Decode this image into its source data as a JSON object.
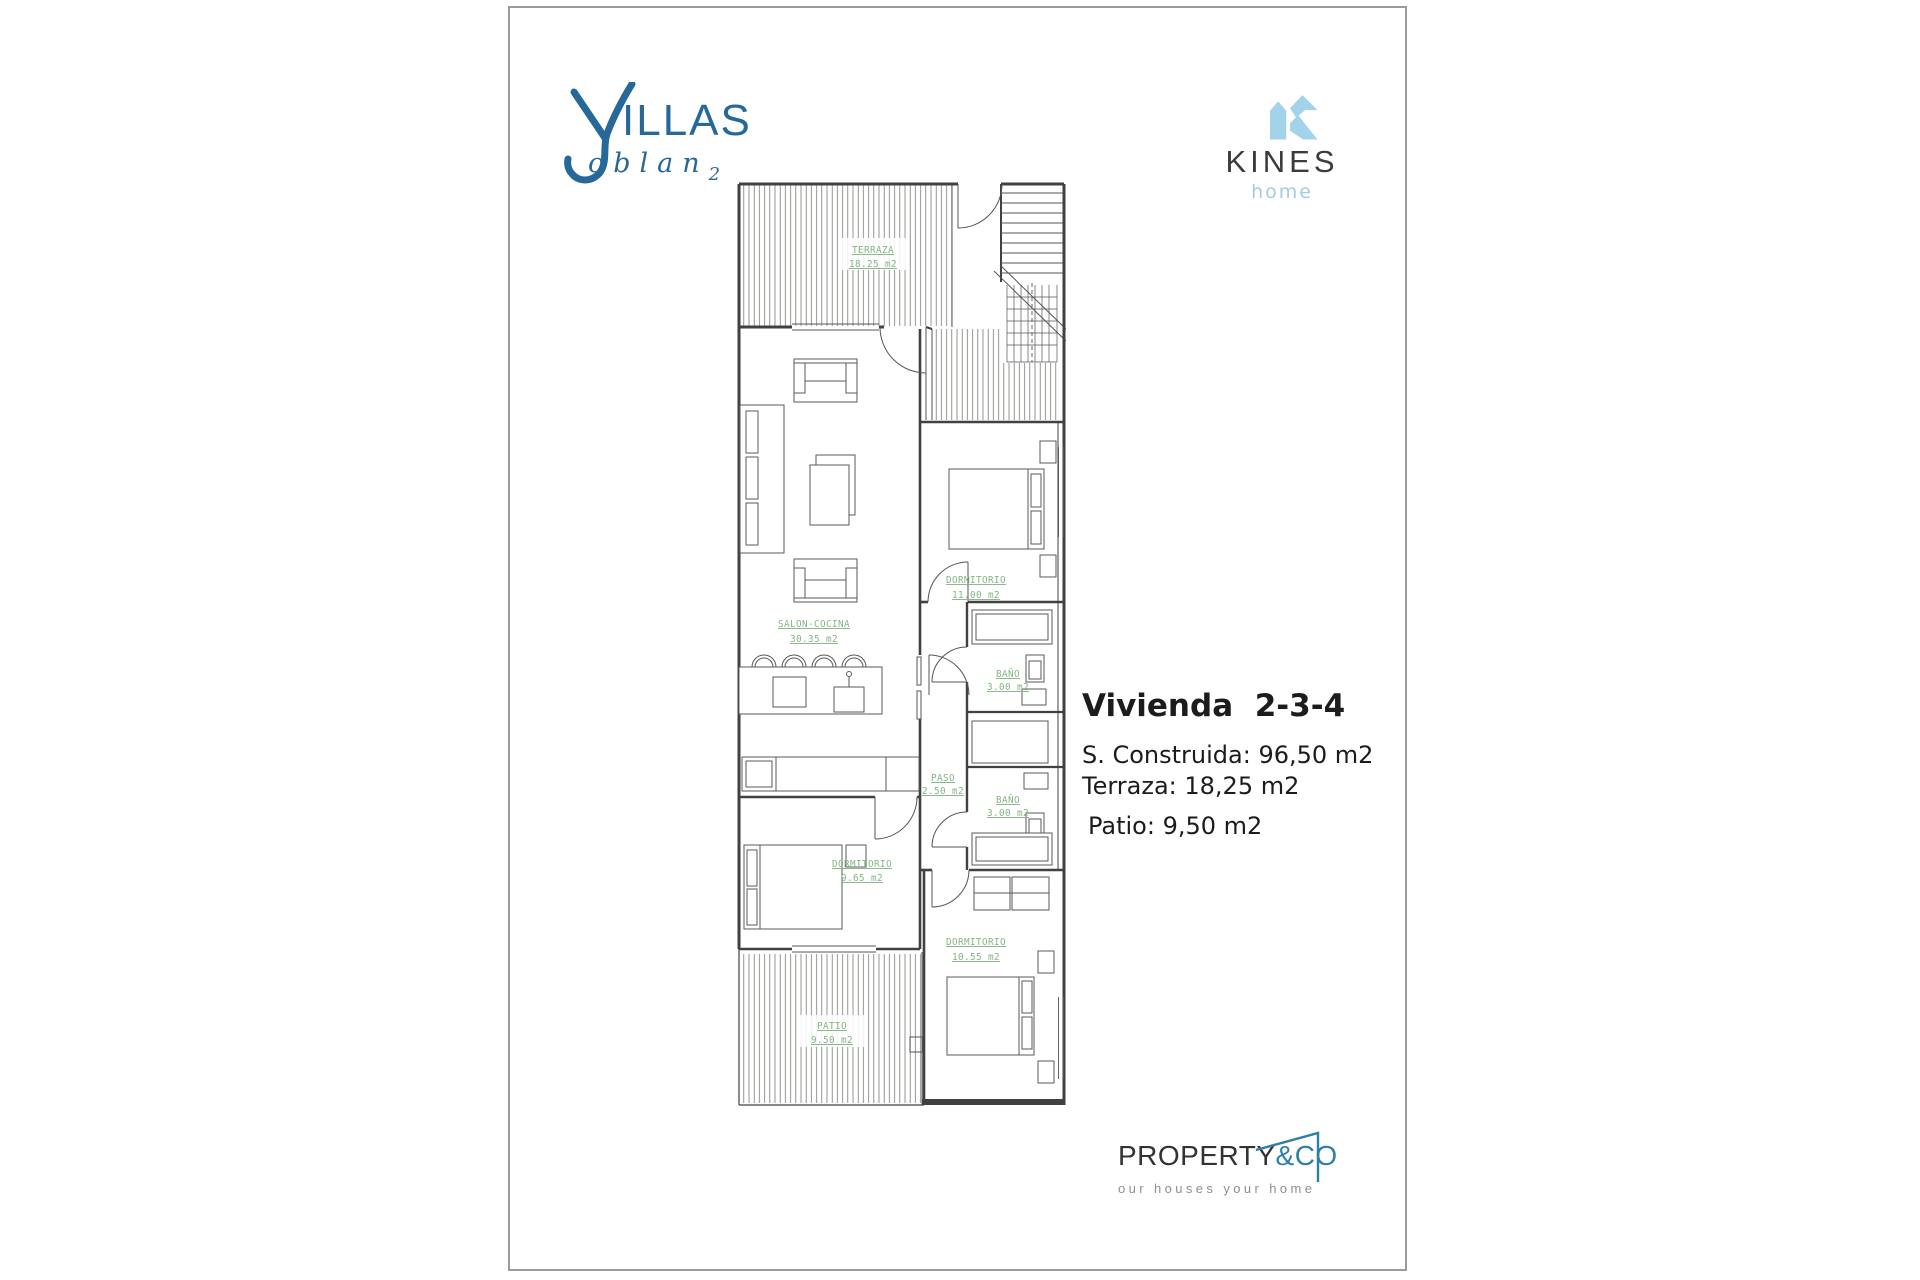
{
  "brand": {
    "villas": {
      "word": "ILLAS",
      "script": "oblan",
      "script_sub": "2",
      "color": "#266899"
    },
    "kines": {
      "name": "KINES",
      "sub": "home",
      "icon_color": "#a3d2eb",
      "text_color": "#3c3c3c"
    }
  },
  "plan": {
    "label_color": "#84b584",
    "rooms": {
      "terraza": {
        "name": "TERRAZA",
        "area": "18.25 m2"
      },
      "salon": {
        "name": "SALON-COCINA",
        "area": "30.35 m2"
      },
      "dormitorio1": {
        "name": "DORMITORIO",
        "area": "11.00 m2"
      },
      "bano1": {
        "name": "BAÑO",
        "area": "3.00 m2"
      },
      "paso": {
        "name": "PASO",
        "area": "2.50 m2"
      },
      "bano2": {
        "name": "BAÑO",
        "area": "3.00 m2"
      },
      "dormitorio2": {
        "name": "DORMITORIO",
        "area": "9.65 m2"
      },
      "dormitorio3": {
        "name": "DORMITORIO",
        "area": "10.55 m2"
      },
      "patio": {
        "name": "PATIO",
        "area": "9.50 m2"
      }
    }
  },
  "info": {
    "title": "Vivienda  2-3-4",
    "line1": "S. Construida: 96,50 m2",
    "line2": "Terraza: 18,25 m2",
    "line3": "Patio: 9,50 m2"
  },
  "footer": {
    "property": {
      "main": "PROPERTY",
      "accent": "&CO",
      "tagline": "our houses your home",
      "accent_color": "#2e7fa6"
    }
  }
}
